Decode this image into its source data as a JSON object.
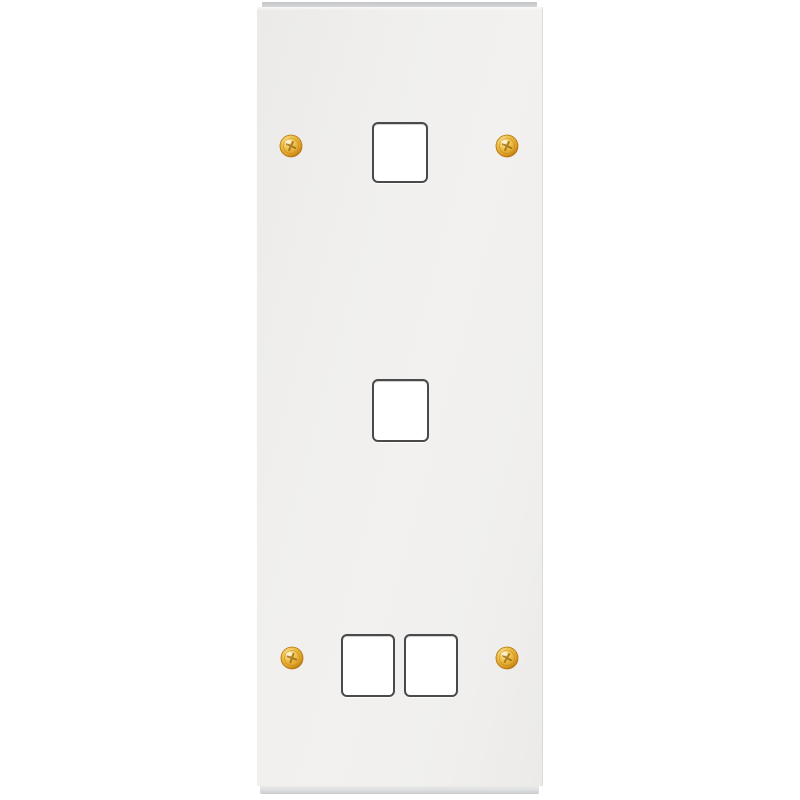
{
  "scene": {
    "type": "product-photo",
    "subject": "Tall white modular faceplate (grid plate) with four square module apertures and four brass fixing screws",
    "orientation": "vertical",
    "aperture_count": 4,
    "aperture_layout": "one top, one middle, two side-by-side at bottom",
    "screw_count": 4,
    "screw_type": "phillips"
  },
  "theme": {
    "background": "#ffffff",
    "plate_face": "#f0efed",
    "plate_face_dark": "#ebeae8",
    "plate_top_edge": "#c3c5c8",
    "plate_top_edge_light": "#d6d8da",
    "plate_bottom_edge": "#dcddde",
    "plate_bottom_edge_dark": "#c9cacc",
    "aperture_fill": "#ffffff",
    "aperture_border": "#4a4a4a",
    "screw_gold_highlight": "#fbeeb4",
    "screw_gold": "#eec04a",
    "screw_gold_deep": "#d99a22",
    "screw_rim": "#a05f08"
  }
}
